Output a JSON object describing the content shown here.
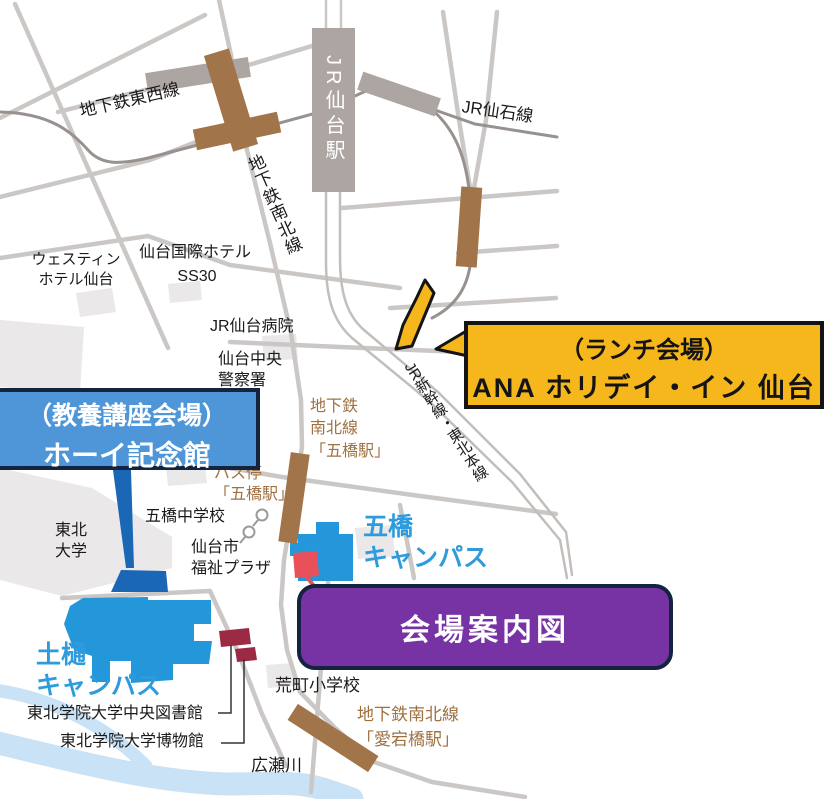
{
  "map_title": "会場案内図",
  "venue_boxes": {
    "lunch": {
      "line1": "（ランチ会場）",
      "line2": "ANA ホリデイ・イン 仙台"
    },
    "lecture": {
      "line1": "（教養講座会場）",
      "line2": "ホーイ記念館"
    }
  },
  "labels": {
    "tozai_line": "地下鉄東西線",
    "jr_sendai_station": "JR仙台駅",
    "jr_senseki_line": "JR仙石線",
    "namboku_line": "地下鉄南北線",
    "westin_hotel": [
      "ウェスティン",
      "ホテル仙台"
    ],
    "kokusai_hotel": "仙台国際ホテル",
    "ss30": "SS30",
    "jr_hospital": "JR仙台病院",
    "police": [
      "仙台中央",
      "警察署"
    ],
    "shinkansen_line": "JR新幹線・東北本線",
    "itsutsubashi_subway": [
      "地下鉄",
      "南北線",
      "「五橋駅」"
    ],
    "bus_stop": [
      "バス停",
      "「五橋駅」"
    ],
    "itsutsubashi_jhs": "五橋中学校",
    "fukushi_plaza": [
      "仙台市",
      "福祉プラザ"
    ],
    "tohoku_univ": [
      "東北",
      "大学"
    ],
    "itsutsubashi_campus": [
      "五橋",
      "キャンパス"
    ],
    "tsuchitoi_campus": [
      "土樋",
      "キャンパス"
    ],
    "central_library": "東北学院大学中央図書館",
    "museum": "東北学院大学博物館",
    "aramachi_es": "荒町小学校",
    "atagobashi_subway": [
      "地下鉄南北線",
      "「愛宕橋駅」"
    ],
    "hirose_river": "広瀬川"
  },
  "colors": {
    "accent_yellow": "#F6B71D",
    "lecture_blue": "#4E96D8",
    "purple": "#7733A3",
    "box_navy": "#14233F",
    "brown": "#A1744A",
    "brown_text": "#9F7140",
    "campus_blue": "#2497DB",
    "campus_dark_blue": "#1A67B5",
    "campus_text": "#2E9BDC",
    "maroon": "#9B2B45",
    "river": "#C9E2F5",
    "road": "#CBC7C5",
    "rail": "#97918F",
    "rail_light": "#C2BEBC",
    "station_gray": "#ACA5A2",
    "block": "#EAE8E8",
    "red_mark": "#E85159"
  }
}
